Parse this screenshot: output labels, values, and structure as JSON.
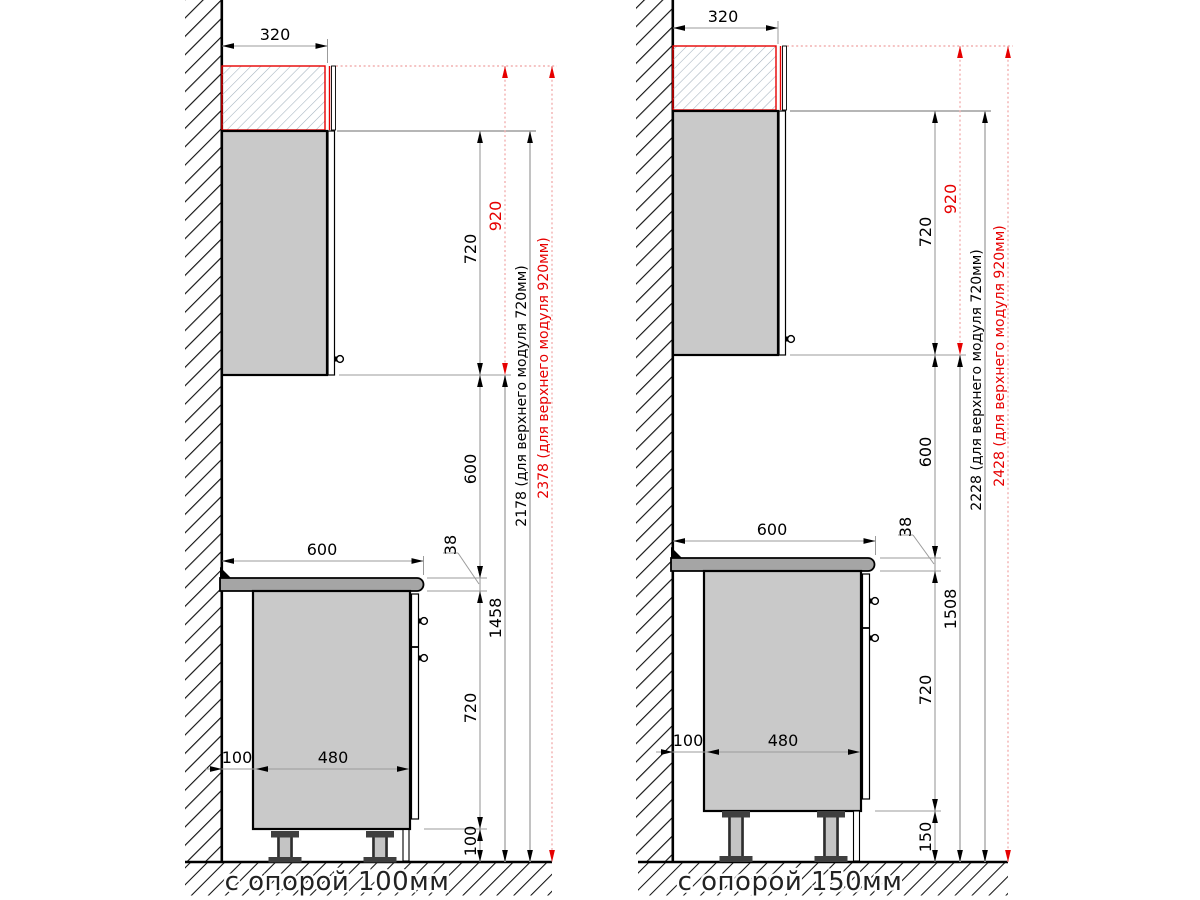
{
  "drawing": {
    "type": "kitchen cabinet installation side-view dimension drawing",
    "colors": {
      "accent_red": "#e60000",
      "red_dashed_line": "#f2b0b0",
      "dim_line_gray": "#9b9b9b",
      "cabinet_fill": "#c9c9c9",
      "countertop_fill": "#a5a5a5",
      "outline": "#000000"
    },
    "panels": {
      "left": {
        "caption": "с опорой 100мм",
        "d320": "320",
        "d720_upper": "720",
        "d920": "920",
        "d600_gap": "600",
        "d600_width": "600",
        "d38": "38",
        "d_floor_to_upper": "1458",
        "d720_base": "720",
        "d_leg": "100",
        "d100_gap": "100",
        "d480": "480",
        "total_720": "2178 (для верхнего модуля 720мм)",
        "total_920": "2378 (для верхнего модуля 920мм)"
      },
      "right": {
        "caption": "с опорой 150мм",
        "d320": "320",
        "d720_upper": "720",
        "d920": "920",
        "d600_gap": "600",
        "d600_width": "600",
        "d38": "38",
        "d_floor_to_upper": "1508",
        "d720_base": "720",
        "d_leg": "150",
        "d100_gap": "100",
        "d480": "480",
        "total_720": "2228 (для верхнего модуля 720мм)",
        "total_920": "2428 (для верхнего модуля 920мм)"
      }
    }
  }
}
